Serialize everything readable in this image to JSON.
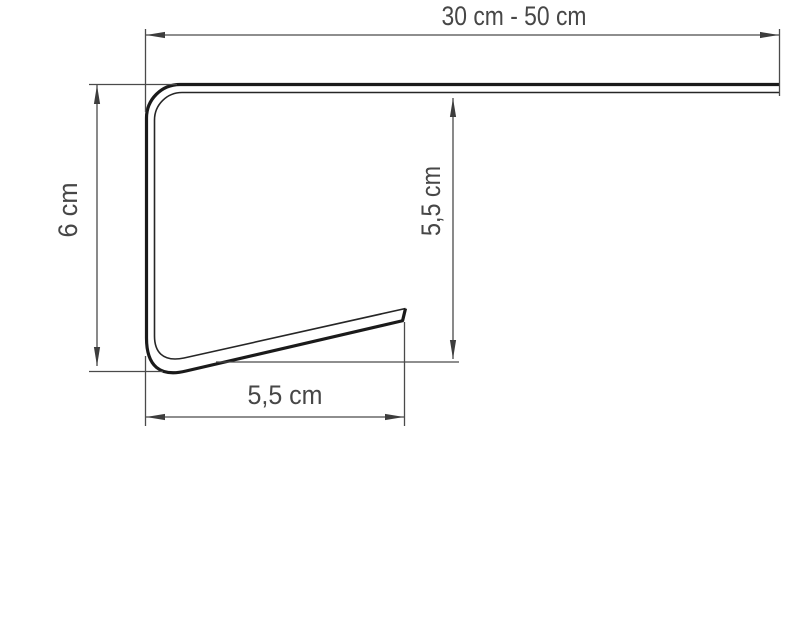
{
  "diagram": {
    "type": "technical profile cross-section drawing",
    "background_color": "#ffffff",
    "colors": {
      "profile_line": "#1a1a1a",
      "dimension_line": "#4a4a4a",
      "label_text": "#474747"
    },
    "dimensions": {
      "top_width": {
        "label": "30 cm - 50 cm",
        "orientation": "horizontal"
      },
      "left_height": {
        "label": "6 cm",
        "orientation": "vertical"
      },
      "inner_height": {
        "label": "5,5 cm",
        "orientation": "vertical"
      },
      "bottom_depth": {
        "label": "5,5 cm",
        "orientation": "horizontal"
      }
    }
  }
}
